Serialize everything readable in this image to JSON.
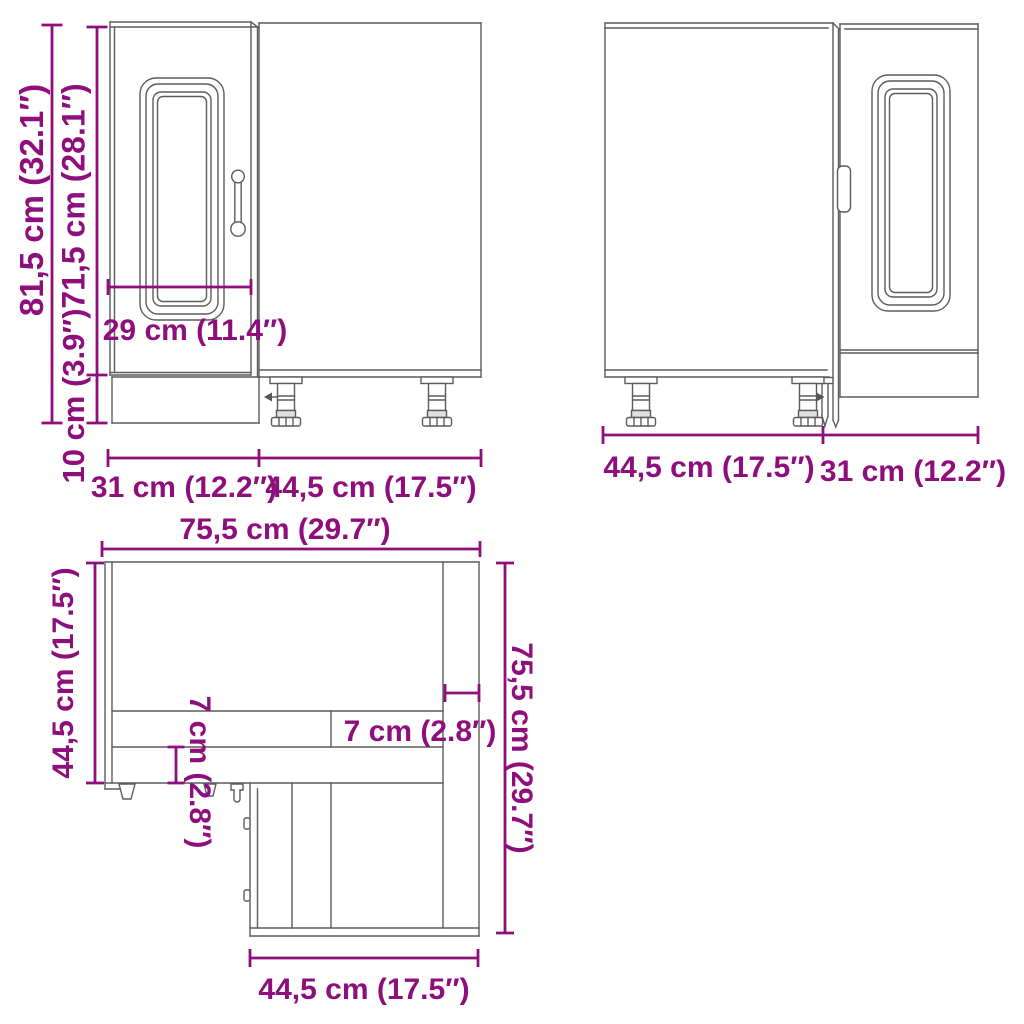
{
  "drawing": {
    "subject": "corner-kitchen-cabinet-dimension-diagram",
    "accent_color": "#8E0E7B",
    "line_color": "#5c5c5c",
    "views": {
      "front_left": {
        "labels": {
          "total_height": "81,5 cm (32.1″)",
          "door_height": "71,5 cm (28.1″)",
          "plinth_height": "10 cm (3.9″)",
          "door_width": "29 cm (11.4″)",
          "width_left": "31 cm (12.2″)",
          "width_right": "44,5 cm (17.5″)"
        }
      },
      "front_right": {
        "labels": {
          "width_left": "44,5 cm (17.5″)",
          "width_right": "31 cm (12.2″)"
        }
      },
      "top": {
        "labels": {
          "width_top": "75,5 cm (29.7″)",
          "depth_left": "44,5 cm (17.5″)",
          "depth_right": "75,5 cm (29.7″)",
          "front_panel_depth": "7 cm (2.8″)",
          "side_panel_width": "7 cm (2.8″)",
          "width_bottom": "44,5 cm (17.5″)"
        }
      }
    }
  }
}
